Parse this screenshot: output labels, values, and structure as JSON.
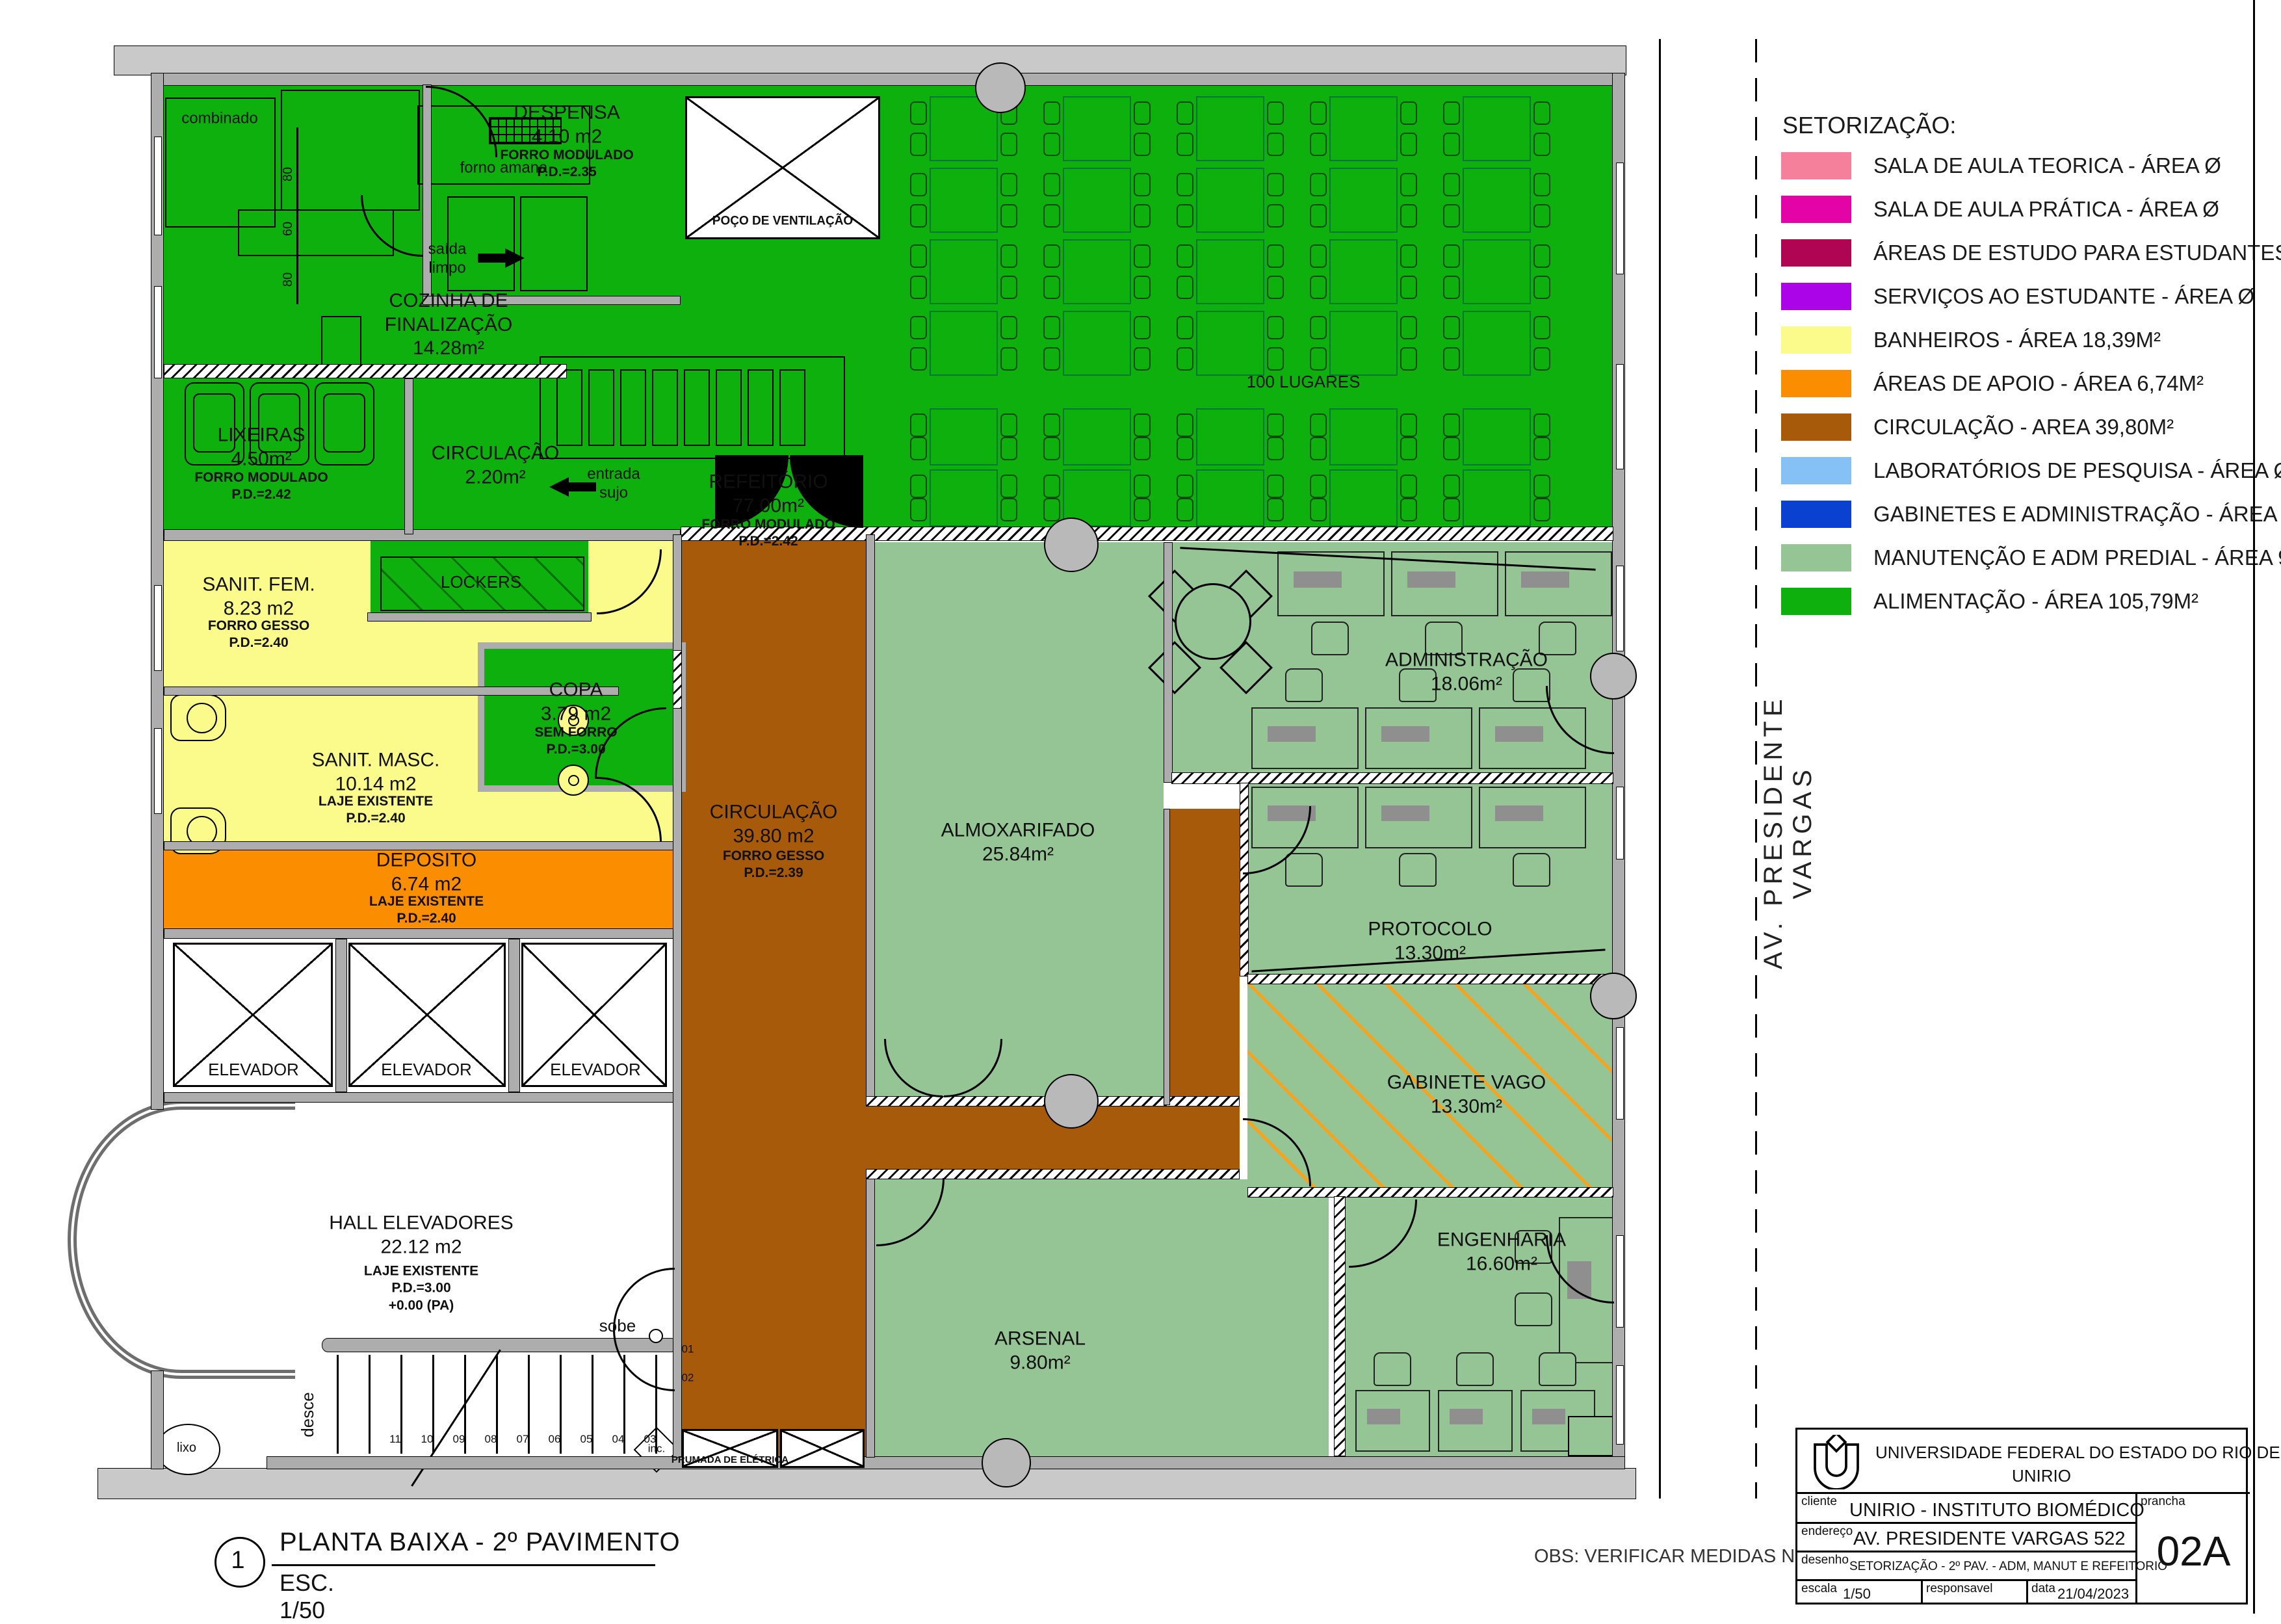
{
  "sheet": {
    "detail_number": "1",
    "view_title": "PLANTA BAIXA - 2º PAVIMENTO",
    "view_scale": "ESC. 1/50",
    "obs": "OBS: VERIFICAR MEDIDAS NO LOCAL",
    "street": "AV.  PRESIDENTE  VARGAS"
  },
  "legend": {
    "title": "SETORIZAÇÃO:",
    "items": [
      {
        "color": "#F4809B",
        "label": "SALA DE AULA TEORICA - ÁREA Ø"
      },
      {
        "color": "#E303A7",
        "label": "SALA DE AULA PRÁTICA - ÁREA Ø"
      },
      {
        "color": "#B00552",
        "label": "ÁREAS DE ESTUDO PARA ESTUDANTES - ÁREA Ø"
      },
      {
        "color": "#AC04E8",
        "label": "SERVIÇOS AO ESTUDANTE - ÁREA Ø"
      },
      {
        "color": "#FBFB8B",
        "label": "BANHEIROS - ÁREA 18,39M²"
      },
      {
        "color": "#FB8D01",
        "label": "ÁREAS DE APOIO - ÁREA 6,74M²"
      },
      {
        "color": "#A85A0B",
        "label": "CIRCULAÇÃO  - AREA 39,80M²"
      },
      {
        "color": "#85C1F5",
        "label": "LABORATÓRIOS DE PESQUISA - ÁREA Ø"
      },
      {
        "color": "#0B41D0",
        "label": "GABINETES E ADMINISTRAÇÃO - ÁREA Ø"
      },
      {
        "color": "#95C495",
        "label": "MANUTENÇÃO E ADM PREDIAL - ÁREA 96,90M²"
      },
      {
        "color": "#0DB00D",
        "label": "ALIMENTAÇÃO - ÁREA 105,79M²"
      }
    ]
  },
  "title_block": {
    "university_line1": "UNIVERSIDADE FEDERAL DO ESTADO DO RIO DE JANEIRO",
    "university_line2": "UNIRIO",
    "cliente_label": "cliente",
    "cliente": "UNIRIO - INSTITUTO BIOMÉDICO",
    "endereco_label": "endereço",
    "endereco": "AV. PRESIDENTE VARGAS 522",
    "desenho_label": "desenho",
    "desenho": "SETORIZAÇÃO - 2º PAV. - ADM, MANUT E REFEITORIO",
    "escala_label": "escala",
    "escala": "1/50",
    "responsavel_label": "responsavel",
    "responsavel": "",
    "data_label": "data",
    "data": "21/04/2023",
    "prancha_label": "prancha",
    "prancha": "02A"
  },
  "rooms": {
    "despensa": {
      "name": "DESPENSA\n4.10 m2",
      "spec": "FORRO MODULADO\nP.D.=2.35"
    },
    "cozinha": {
      "name": "COZINHA DE\nFINALIZAÇÃO\n14.28m²"
    },
    "lixeiras": {
      "name": "LIXEIRAS\n4.50m²",
      "spec": "FORRO MODULADO\nP.D.=2.42"
    },
    "circ_cozinha": {
      "name": "CIRCULAÇÃO\n2.20m²"
    },
    "refeitorio": {
      "name": "REFEITÓRIO\n77.00m²",
      "spec": "FORRO MODULADO\nP.D.=2.42"
    },
    "sanit_fem": {
      "name": "SANIT.  FEM.\n8.23 m2",
      "spec": "FORRO GESSO\nP.D.=2.40"
    },
    "sanit_masc": {
      "name": "SANIT.  MASC.\n10.14 m2",
      "spec": "LAJE EXISTENTE\nP.D.=2.40"
    },
    "copa": {
      "name": "COPA\n3.79 m2",
      "spec": "SEM FORRO\nP.D.=3.00"
    },
    "deposito": {
      "name": "DEPOSITO\n6.74 m2",
      "spec": "LAJE EXISTENTE\nP.D.=2.40"
    },
    "hall": {
      "name": "HALL  ELEVADORES\n22.12 m2",
      "spec": "LAJE EXISTENTE\nP.D.=3.00\n+0.00  (PA)"
    },
    "circulacao": {
      "name": "CIRCULAÇÃO\n39.80 m2",
      "spec": "FORRO GESSO\nP.D.=2.39"
    },
    "almoxarifado": {
      "name": "ALMOXARIFADO\n25.84m²"
    },
    "administracao": {
      "name": "ADMINISTRAÇÃO\n18.06m²"
    },
    "protocolo": {
      "name": "PROTOCOLO\n13.30m²"
    },
    "gabinete": {
      "name": "GABINETE VAGO\n13.30m²"
    },
    "arsenal": {
      "name": "ARSENAL\n9.80m²"
    },
    "engenharia": {
      "name": "ENGENHARIA\n16.60m²"
    },
    "poco": "POÇO  DE  VENTILAÇÃO",
    "prumada": "PRUMADA DE ELÉTRICA",
    "elevador": "ELEVADOR"
  },
  "annotations": {
    "lugares": "100 LUGARES",
    "combinado": "combinado",
    "forno": "forno amana",
    "lockers": "LOCKERS",
    "saida": "saída\nlimpo",
    "entrada": "entrada\nsujo",
    "sobe": "sobe",
    "desce": "desce",
    "lixo": "lixo",
    "inc": "inc.",
    "dim_80a": "80",
    "dim_60": "60",
    "dim_80b": "80",
    "n01": "01",
    "n02": "02"
  },
  "stairs": {
    "numbers": [
      "11",
      "10",
      "09",
      "08",
      "07",
      "06",
      "05",
      "04",
      "03"
    ]
  },
  "colors": {
    "alimentacao": "#0DB00D",
    "manutencao": "#95C495",
    "banheiros": "#FBFB8B",
    "apoio": "#FB8D01",
    "circulacao": "#A85A0B",
    "hatch_orange": "#F5A41F"
  }
}
